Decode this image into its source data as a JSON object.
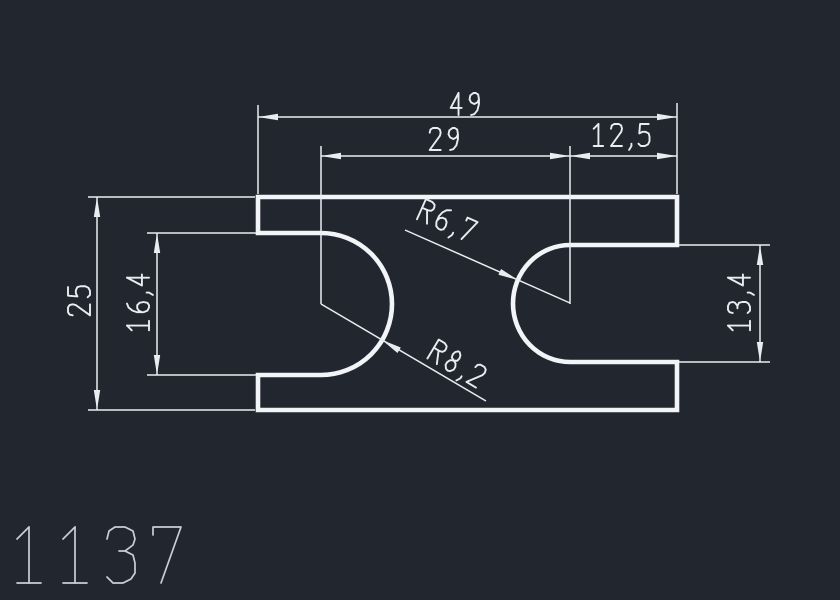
{
  "drawing": {
    "part_label": "1137",
    "dimensions": [
      {
        "id": "overall_width",
        "value": "49"
      },
      {
        "id": "slot_center_distance",
        "value": "29"
      },
      {
        "id": "right_slot_center_offset",
        "value": "12,5"
      },
      {
        "id": "overall_height",
        "value": "25"
      },
      {
        "id": "left_slot_height",
        "value": "16,4"
      },
      {
        "id": "right_slot_height",
        "value": "13,4"
      },
      {
        "id": "right_slot_radius",
        "value": "R6,7"
      },
      {
        "id": "left_slot_radius",
        "value": "R8,2"
      }
    ],
    "colors": {
      "background": "#22272f",
      "outline": "#f2f4f7",
      "dimension": "#e9edf1",
      "label": "#c9cfd7"
    }
  }
}
